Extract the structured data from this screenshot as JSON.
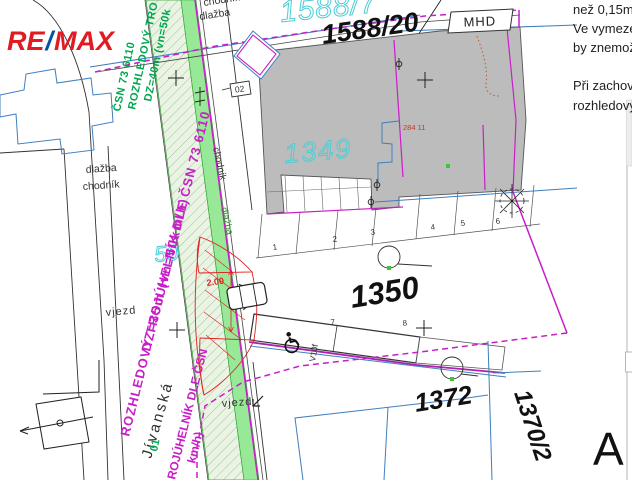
{
  "logo": {
    "re": "RE",
    "slash": "/",
    "max": "MAX"
  },
  "parcels": {
    "road_top": "1588/7",
    "top": "1588/20",
    "building": "1349",
    "yard": "1350",
    "south": "1372",
    "southeast": "1370/2",
    "road_label_partial": "50",
    "building_number_red": "284 11"
  },
  "transit": {
    "stop": "MHD"
  },
  "marks": {
    "box": "02",
    "sign": "V10f",
    "dimension": "2.00",
    "section": "A"
  },
  "street": {
    "name": "Jívanská"
  },
  "surface_labels": {
    "top_chodnik": "chodník",
    "top_dlazba": "dlažba",
    "left_dlazba": "dlažba",
    "left_chodnik": "chodník",
    "strip_chodnik": "chodník",
    "strip_dlazba": "dlažba",
    "vjezd_left": "vjezd",
    "vjezd_bottom": "vjezd"
  },
  "sight_triangles": {
    "green_line1": "ROZHLEDOVÝ TRO",
    "green_line2": "ČSN 73 6110",
    "green_line3": "DZ=40m (vn=50k",
    "magenta_line1": "ROZHLEDOVÝ TROJÚHELNÍK DLE ČSN 73 6110",
    "magenta_line2": "DZ=35m (vn=50km/h)",
    "bottom_green": "01",
    "bottom_magenta1": "ROJÚHELNÍK DLE ČSN",
    "bottom_magenta2": "km/h)"
  },
  "parking": {
    "n1": "1",
    "n2": "2",
    "n3": "3",
    "n4": "4",
    "n5": "5",
    "n6": "6",
    "n7": "7",
    "n8": "8"
  },
  "notes": {
    "line1": "než 0,15m",
    "line2": "Ve vymeze",
    "line3": "by znemož",
    "line4": "Při zachova",
    "line5": "rozhledový"
  },
  "colors": {
    "magenta": "#c81ec8",
    "green": "#00a651",
    "cyan": "#4ccdd6",
    "red": "#e02020",
    "blue_line": "#3f7fbf",
    "building_gray": "#bcbcbc",
    "logo_red": "#e11b22",
    "logo_blue": "#0054a6"
  }
}
